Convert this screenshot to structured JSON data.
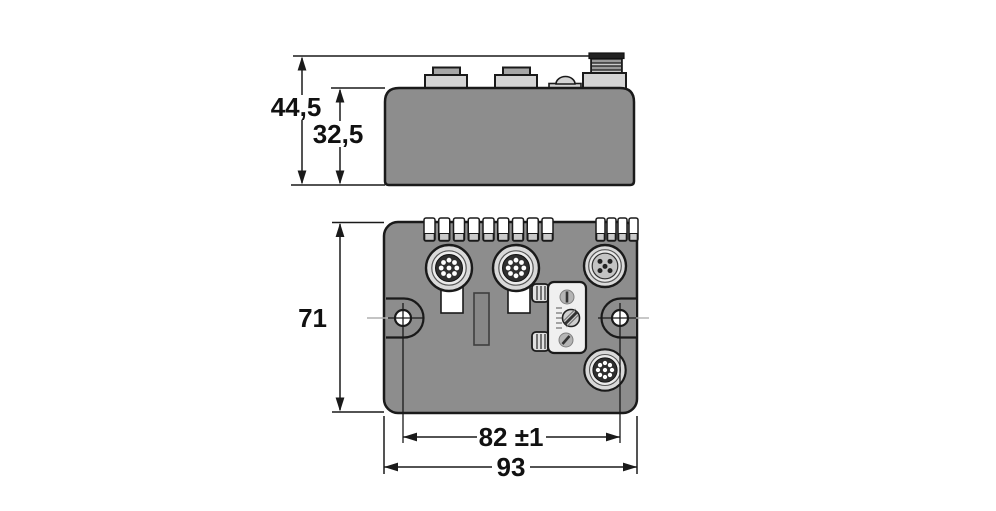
{
  "page": {
    "type": "technical dimension drawing",
    "background": "#ffffff"
  },
  "colors": {
    "housing_gray": "#8d8d8d",
    "outline": "#1a1a1a",
    "fitting_light": "#d4d4d4",
    "fitting_cap": "#a6a6a6",
    "thread_dark": "#4a4a4a",
    "connector_ring": "#d9d9d9",
    "connector_face_dark": "#2f2f2f",
    "dimension_text": "#111111",
    "centerline_light": "#b0b0b0"
  },
  "side_view": {
    "dimensions": {
      "total_height": "44,5",
      "housing_height": "32,5"
    },
    "components": [
      "connector-boss",
      "connector-boss",
      "pressure-vent",
      "m12-male-threaded-connector"
    ]
  },
  "front_view": {
    "dimensions": {
      "height": "71",
      "mounting_hole_spacing": "82 ±1",
      "width": "93"
    },
    "label_tab_groups": [
      {
        "count": 9
      },
      {
        "count": 4
      }
    ],
    "connectors": [
      "m12-female-multipin",
      "m12-female-multipin",
      "m12-female-5pin",
      "m12-female-multipin"
    ],
    "mounting_holes": 2,
    "controls": [
      "address-switch-with-screw"
    ]
  }
}
